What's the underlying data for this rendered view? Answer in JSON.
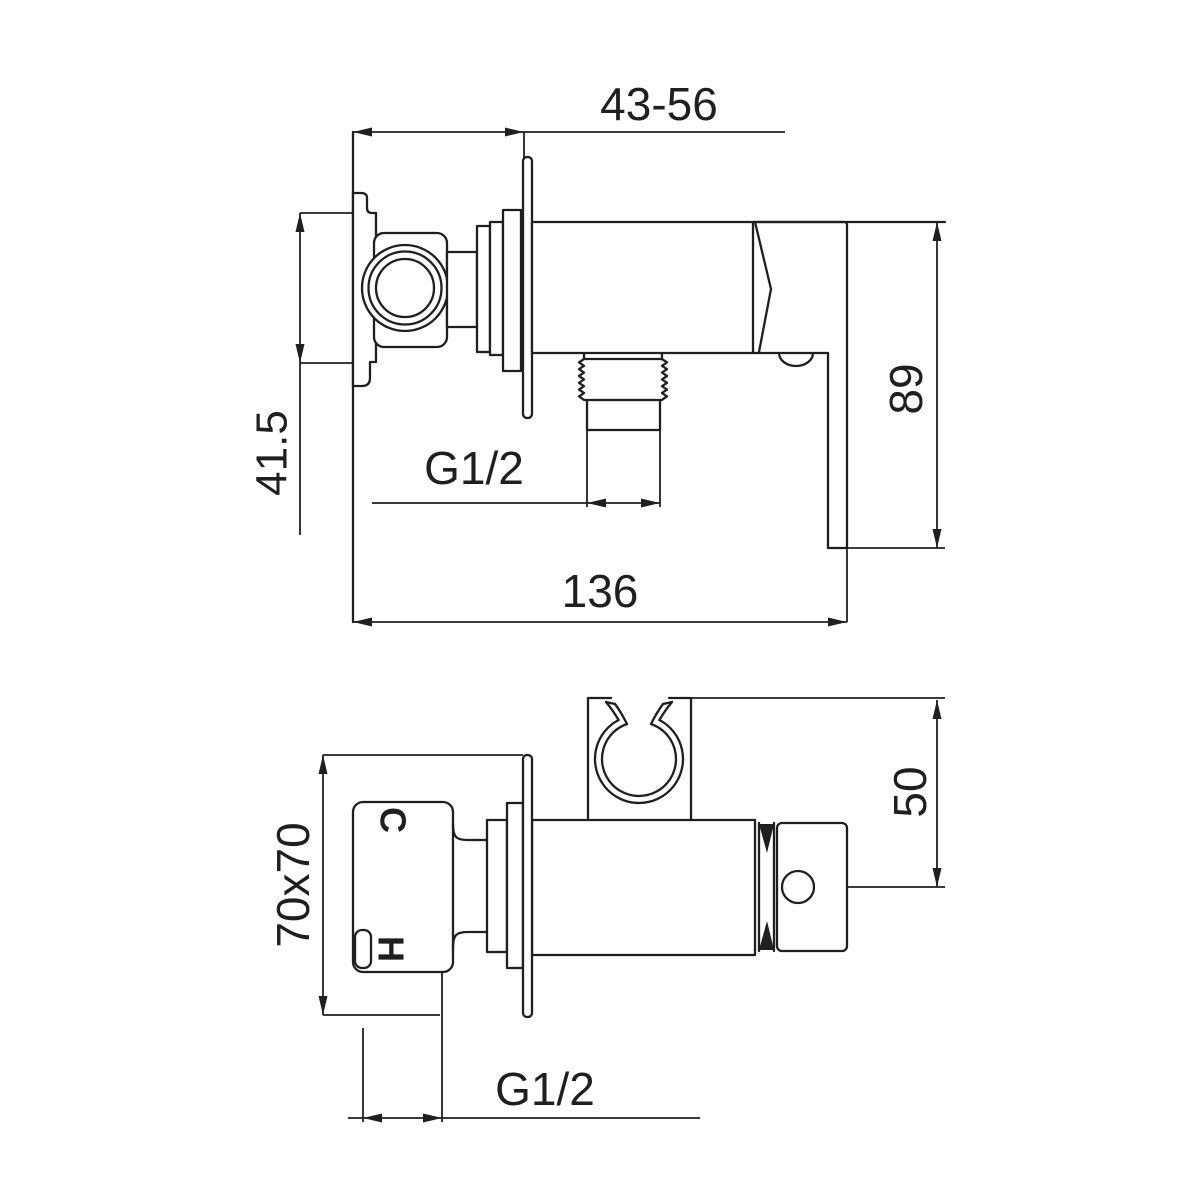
{
  "colors": {
    "background": "#ffffff",
    "line": "#1f1f1f"
  },
  "views": {
    "side_view": {
      "dims": {
        "depth_range": "43-56",
        "rough_in_height": "41.5",
        "outlet_thread": "G1/2",
        "overall_length": "136",
        "handle_height": "89"
      }
    },
    "front_view": {
      "dims": {
        "wall_plate": "70x70",
        "holder_offset": "50",
        "inlet_thread": "G1/2"
      },
      "ports": {
        "cold": "C",
        "hot": "H"
      }
    }
  }
}
